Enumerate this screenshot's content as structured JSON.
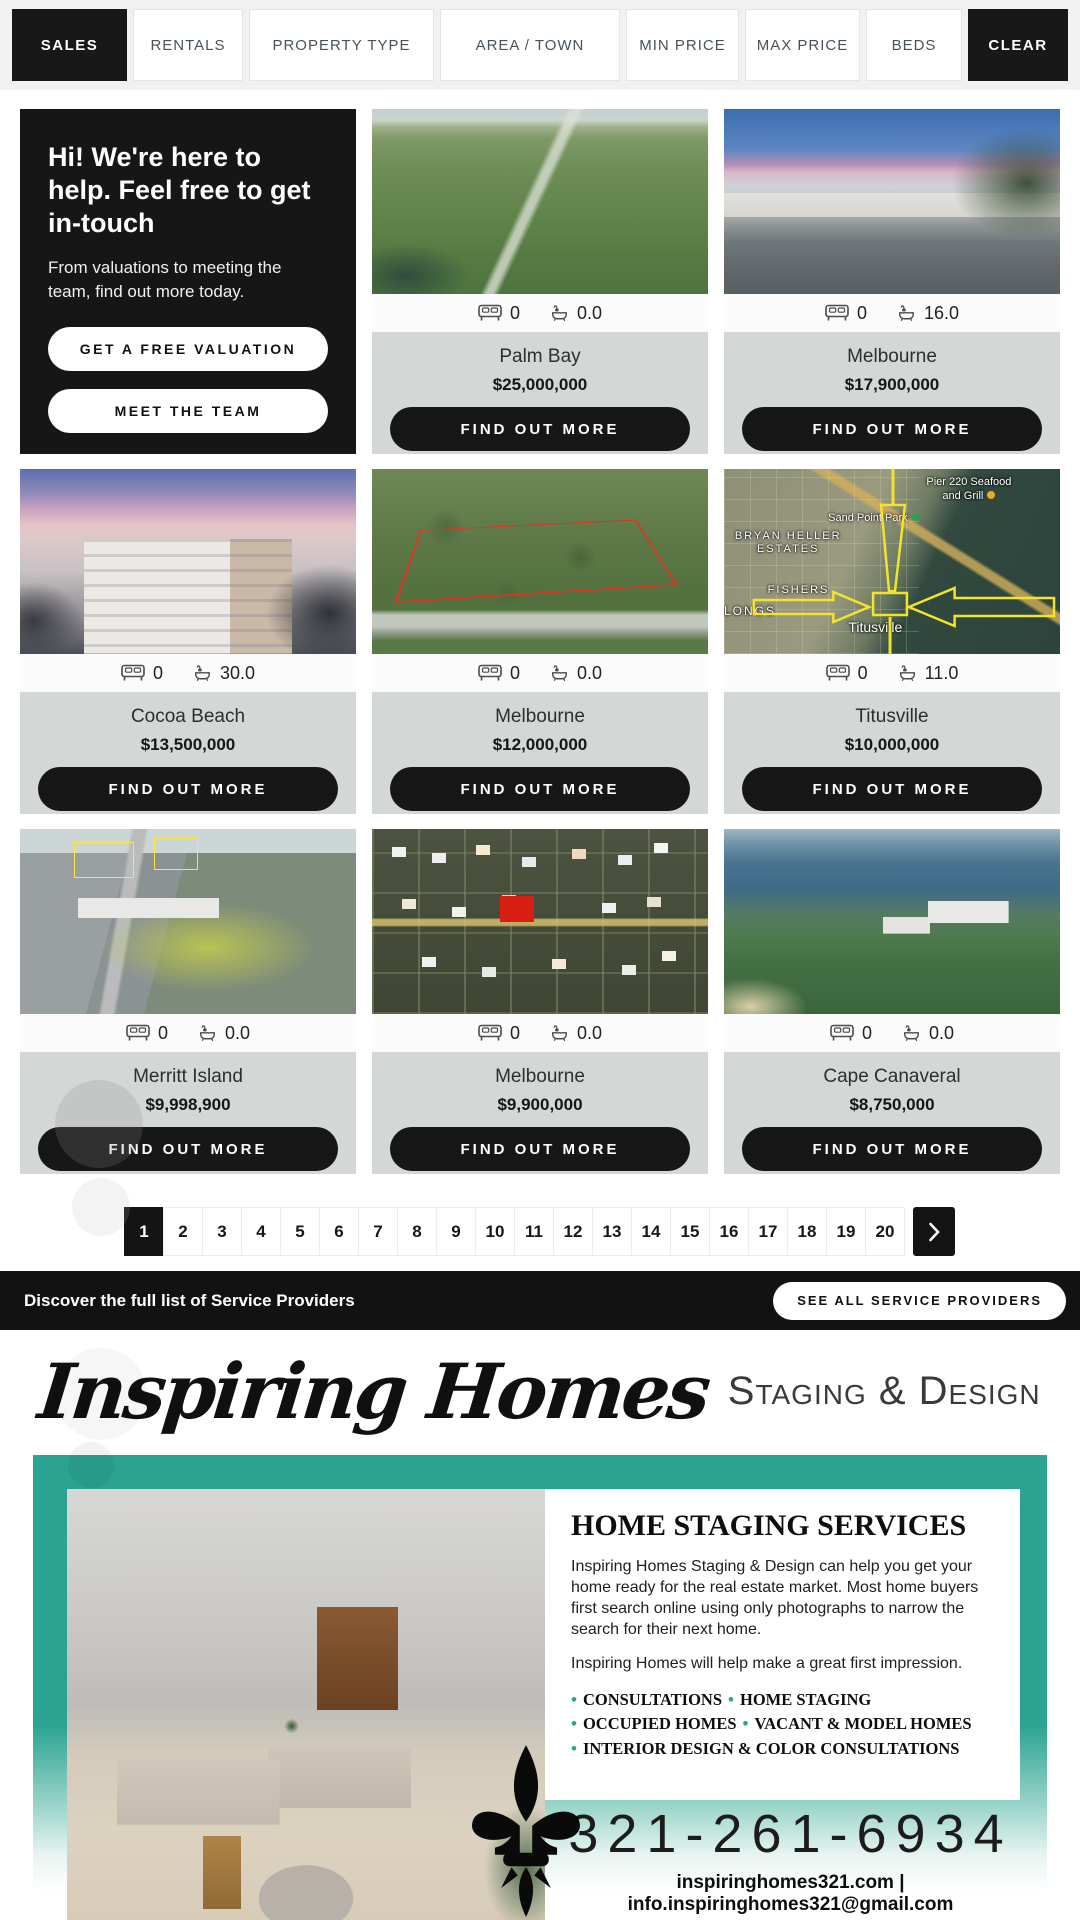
{
  "filters": {
    "items": [
      {
        "label": "SALES",
        "dark": true
      },
      {
        "label": "RENTALS",
        "dark": false
      },
      {
        "label": "PROPERTY TYPE",
        "dark": false
      },
      {
        "label": "AREA / TOWN",
        "dark": false
      },
      {
        "label": "MIN PRICE",
        "dark": false
      },
      {
        "label": "MAX PRICE",
        "dark": false
      },
      {
        "label": "BEDS",
        "dark": false
      },
      {
        "label": "CLEAR",
        "dark": true
      }
    ]
  },
  "promo": {
    "title": "Hi! We're here to help. Feel free to get in-touch",
    "body": "From valuations to meeting the team, find out more today.",
    "primary_button": "GET A FREE VALUATION",
    "secondary_button": "MEET THE TEAM"
  },
  "labels": {
    "find_out_more": "FIND OUT MORE"
  },
  "listings": [
    {
      "town": "Palm Bay",
      "price": "$25,000,000",
      "beds": "0",
      "baths": "0.0",
      "photo": "aerial-green-land"
    },
    {
      "town": "Melbourne",
      "price": "$17,900,000",
      "beds": "0",
      "baths": "16.0",
      "photo": "office-building-palm"
    },
    {
      "town": "Cocoa Beach",
      "price": "$13,500,000",
      "beds": "0",
      "baths": "30.0",
      "photo": "condo-building-sunset"
    },
    {
      "town": "Melbourne",
      "price": "$12,000,000",
      "beds": "0",
      "baths": "0.0",
      "photo": "aerial-wooded-parcel-red-outline"
    },
    {
      "town": "Titusville",
      "price": "$10,000,000",
      "beds": "0",
      "baths": "11.0",
      "photo": "annotated-satellite-map",
      "map": {
        "poi": "Pier 220 Seafood and Grill",
        "park": "Sand Point Park",
        "area1": "BRYAN HELLER ESTATES",
        "area2": "FISHERS",
        "area3": "LONGS",
        "town_label": "Titusville"
      }
    },
    {
      "town": "Merritt Island",
      "price": "$9,998,900",
      "beds": "0",
      "baths": "0.0",
      "photo": "aerial-commercial-annotated"
    },
    {
      "town": "Melbourne",
      "price": "$9,900,000",
      "beds": "0",
      "baths": "0.0",
      "photo": "retail-plaza-satellite-logos"
    },
    {
      "town": "Cape Canaveral",
      "price": "$8,750,000",
      "beds": "0",
      "baths": "0.0",
      "photo": "aerial-coastal-condos"
    }
  ],
  "pagination": {
    "pages": [
      "1",
      "2",
      "3",
      "4",
      "5",
      "6",
      "7",
      "8",
      "9",
      "10",
      "11",
      "12",
      "13",
      "14",
      "15",
      "16",
      "17",
      "18",
      "19",
      "20"
    ],
    "active": "1"
  },
  "service_bar": {
    "text": "Discover the full list of Service Providers",
    "button": "SEE ALL SERVICE PROVIDERS"
  },
  "brand": {
    "script": "Inspiring Homes",
    "suffix": "Staging & Design"
  },
  "flyer": {
    "heading": "HOME STAGING SERVICES",
    "para1": "Inspiring Homes Staging & Design can help you get your home ready for the real estate market. Most home buyers first search online using only photographs to narrow the search for their next home.",
    "para2": "Inspiring Homes will help make a great first impression.",
    "bullets": [
      {
        "a": "CONSULTATIONS",
        "b": "HOME STAGING"
      },
      {
        "a": "OCCUPIED HOMES",
        "b": "VACANT & MODEL HOMES"
      },
      {
        "a": "INTERIOR DESIGN & COLOR CONSULTATIONS"
      }
    ],
    "phone": "321-261-6934",
    "contact": "inspiringhomes321.com | info.inspiringhomes321@gmail.com"
  },
  "colors": {
    "accent_teal": "#2aa392",
    "dark": "#161616",
    "card_info_bg": "#d3d7d5"
  }
}
